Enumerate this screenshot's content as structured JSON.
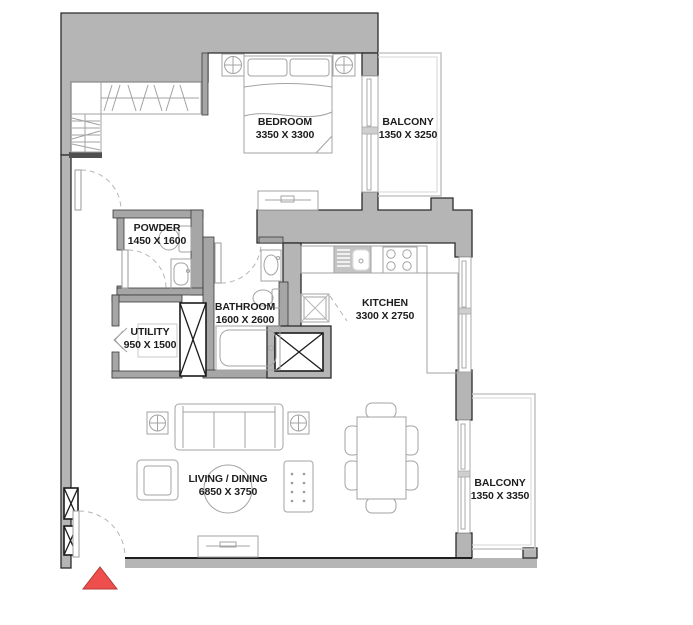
{
  "title": "apartment-floor-plan",
  "colors": {
    "wall_mass": "#b5b5b5",
    "wall_outline": "#2c2c2c",
    "partition_fill": "#a6a6a6",
    "furniture_line": "#a3a3a3",
    "railing_line": "#c6c6c6",
    "door_arc": "#b5b5b5",
    "shaft_line": "#1c1c1c",
    "entrance_red": "#ee4f4c",
    "entrance_red_border": "#b03a36",
    "label_text": "#1d1d1d",
    "background": "#ffffff"
  },
  "rooms": [
    {
      "name": "BEDROOM",
      "dims": "3350 X 3300"
    },
    {
      "name": "BALCONY",
      "dims": "1350 X 3250"
    },
    {
      "name": "POWDER",
      "dims": "1450 X 1600"
    },
    {
      "name": "BATHROOM",
      "dims": "1600 X 2600"
    },
    {
      "name": "UTILITY",
      "dims": "950 X 1500"
    },
    {
      "name": "KITCHEN",
      "dims": "3300 X 2750"
    },
    {
      "name": "LIVING / DINING",
      "dims": "6850 X 3750"
    },
    {
      "name": "BALCONY",
      "dims": "1350 X 3350"
    }
  ],
  "furniture_icons": [
    "bed-icon",
    "pillow-icon",
    "nightstand-icon",
    "wardrobe-icon",
    "shelf-icon",
    "tv-console-icon",
    "sofa-icon",
    "armchair-icon",
    "side-table-icon",
    "rug-icon",
    "coffee-table-icon",
    "dining-table-icon",
    "dining-chair-icon",
    "kitchen-sink-icon",
    "stove-icon",
    "counter-icon",
    "washing-machine-icon",
    "toilet-icon",
    "sink-icon",
    "bathtub-icon",
    "shaft-icon",
    "door-swing-icon",
    "window-icon",
    "balcony-railing-icon",
    "entrance-marker"
  ]
}
